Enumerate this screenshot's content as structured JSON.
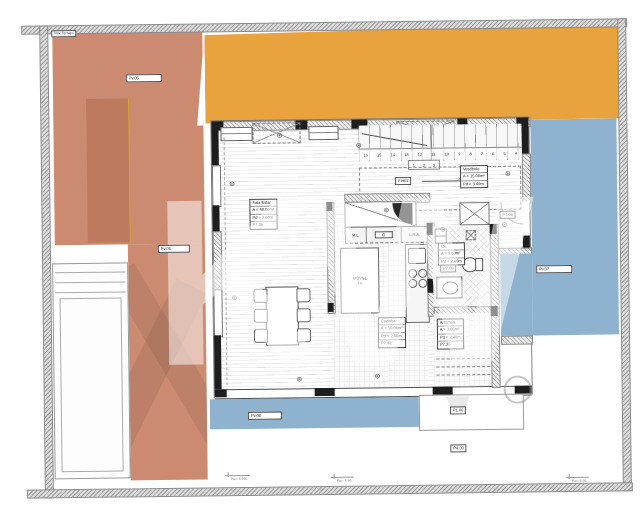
{
  "colors": {
    "terrace": "#cc8b71",
    "terrace_dark": "#bd7a5e",
    "accent_yellow": "#d8a23c",
    "orange": "#e9a33e",
    "blue": "#8fb3ce",
    "wall_gray": "#9a9a9a",
    "line": "#555555"
  },
  "labels": {
    "corner": "Pav. Terraço",
    "pv05_a": "Pv.05",
    "pv05_b": "Pv.05",
    "pv07": "Pv.07",
    "pv08": "Pv.08",
    "p1": "P1.00",
    "p4": "P4.00",
    "p706": "P7.06",
    "p708": "P7.08",
    "fh02": "F.H02",
    "pd140": "Pd - 1.40",
    "pav_a": "Pav: 6.965",
    "pav_b": "Pav: 6.96",
    "pav_c": "Pav: 6.96"
  },
  "rooms": {
    "sala": {
      "l1": "Sala Estar",
      "l2": "A = 48.06m²",
      "l3": "Pd = 2.60m",
      "l4": "P7.36"
    },
    "cozinha": {
      "l1": "Cozinha",
      "l2": "A = 10.06m²",
      "l3": "Pd = 2.56m",
      "l4": "P7.42"
    },
    "hall": {
      "l1": "Vestíbulo",
      "l2": "A = 15.00m²",
      "l3": "Pd = 3.40m"
    },
    "wc": {
      "l1": "I.S.",
      "l2": "A = 3.60m²",
      "l3": "Pd = 2.40m"
    },
    "arrumos": {
      "l1": "Arrumos",
      "l2": "A = 3.05m²",
      "l3": "Pd = 2.40m",
      "l4": "P7.35"
    }
  },
  "kitchen": {
    "ml": "M.L.",
    "oven": "O",
    "lra": "L.R.A.",
    "unit1": "MÓVEL",
    "unit2": "TV"
  },
  "stairs": {
    "n": [
      "16",
      "15",
      "14",
      "13",
      "12",
      "11",
      "10",
      "9",
      "8",
      "7",
      "6",
      "5",
      "4"
    ],
    "m": [
      "1",
      "2",
      "3"
    ]
  },
  "watermark": {
    "text": "KW"
  }
}
